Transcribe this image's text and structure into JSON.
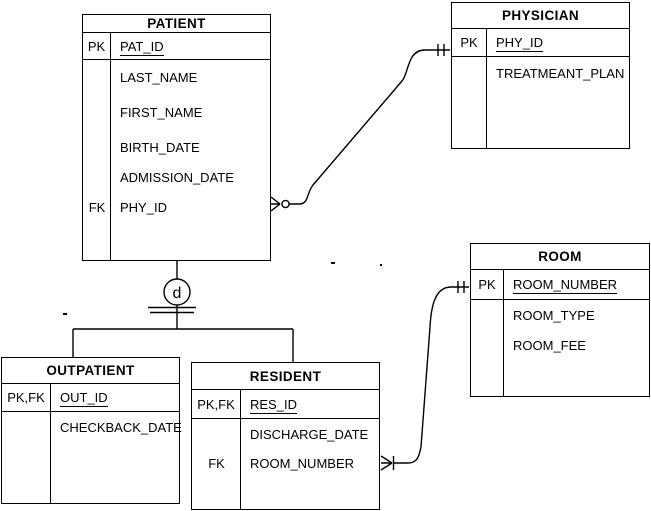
{
  "colors": {
    "line": "#000000",
    "background": "#ffffff",
    "text": "#000000"
  },
  "diagram": {
    "disjoint_label": "d"
  },
  "tables": {
    "patient": {
      "title": "PATIENT",
      "pk": {
        "key": "PK",
        "name": "PAT_ID"
      },
      "attributes": [
        {
          "key": "",
          "name": "LAST_NAME"
        },
        {
          "key": "",
          "name": "FIRST_NAME"
        },
        {
          "key": "",
          "name": "BIRTH_DATE"
        },
        {
          "key": "",
          "name": "ADMISSION_DATE"
        },
        {
          "key": "FK",
          "name": "PHY_ID"
        }
      ]
    },
    "physician": {
      "title": "PHYSICIAN",
      "pk": {
        "key": "PK",
        "name": "PHY_ID"
      },
      "attributes": [
        {
          "key": "",
          "name": "TREATMEANT_PLAN"
        }
      ]
    },
    "room": {
      "title": "ROOM",
      "pk": {
        "key": "PK",
        "name": "ROOM_NUMBER"
      },
      "attributes": [
        {
          "key": "",
          "name": "ROOM_TYPE"
        },
        {
          "key": "",
          "name": "ROOM_FEE"
        }
      ]
    },
    "outpatient": {
      "title": "OUTPATIENT",
      "pk": {
        "key": "PK,FK",
        "name": "OUT_ID"
      },
      "attributes": [
        {
          "key": "",
          "name": "CHECKBACK_DATE"
        }
      ]
    },
    "resident": {
      "title": "RESIDENT",
      "pk": {
        "key": "PK,FK",
        "name": "RES_ID"
      },
      "attributes": [
        {
          "key": "",
          "name": "DISCHARGE_DATE"
        },
        {
          "key": "FK",
          "name": "ROOM_NUMBER"
        }
      ]
    }
  }
}
